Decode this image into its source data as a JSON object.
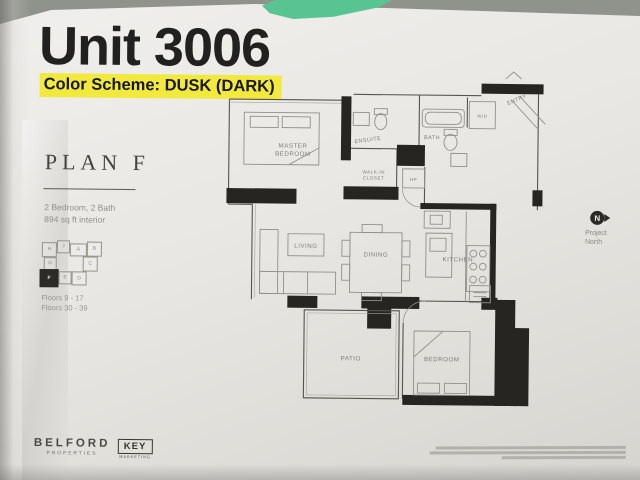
{
  "document": {
    "unit_title": "Unit 3006",
    "color_scheme_label": "Color Scheme: DUSK (DARK)"
  },
  "plan": {
    "name": "PLAN F",
    "spec_line1": "2 Bedroom, 2 Bath",
    "spec_line2": "894 sq ft interior",
    "floors_line1": "Floors 9 - 17",
    "floors_line2": "Floors 30 - 39"
  },
  "keyplan": {
    "highlighted_unit": "F",
    "units": [
      "H",
      "J",
      "A",
      "B",
      "G",
      "C",
      "F",
      "E",
      "D"
    ]
  },
  "floorplan": {
    "rooms": {
      "master_line1": "MASTER",
      "master_line2": "BEDROOM",
      "ensuite": "ENSUITE",
      "walkin_line1": "WALK-IN",
      "walkin_line2": "CLOSET",
      "bath": "BATH",
      "wd": "W/D",
      "hp": "HP",
      "entry": "ENTRY",
      "living": "LIVING",
      "dining": "DINING",
      "kitchen": "KITCHEN",
      "patio": "PATIO",
      "bedroom": "BEDROOM"
    }
  },
  "compass": {
    "letter": "N",
    "label_line1": "Project",
    "label_line2": "North"
  },
  "footer": {
    "brand1_name": "BELFORD",
    "brand1_sub": "PROPERTIES",
    "brand2_name": "KEY",
    "brand2_sub": "MARKETING"
  },
  "colors": {
    "highlight_yellow": "#f2e93e",
    "paper": "#e9e7e3",
    "background_gray": "#90928c",
    "green_object": "#57c492",
    "ink_black": "#21211f",
    "plan_label_gray": "#817e76"
  }
}
